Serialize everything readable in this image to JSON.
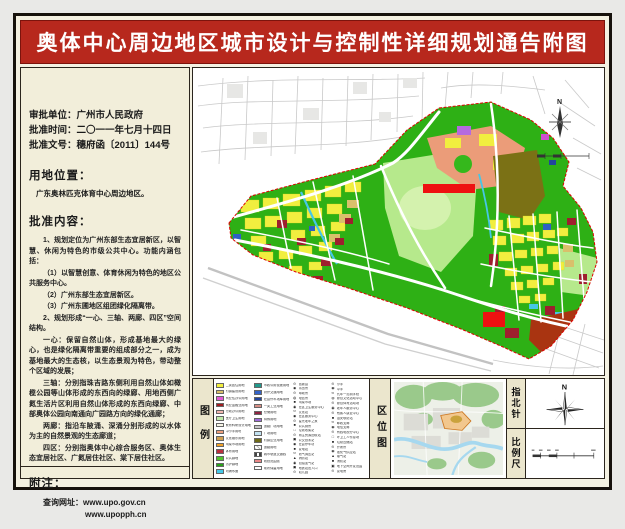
{
  "title": "奥体中心周边地区城市设计与控制性详细规划通告附图",
  "info": {
    "approval_unit_label": "审批单位：",
    "approval_unit": "广州市人民政府",
    "approval_date_label": "批准时间：",
    "approval_date": "二〇一一年七月十四日",
    "approval_doc_label": "批准文号：",
    "approval_doc": "穗府函〔2011〕144号"
  },
  "location_section": {
    "heading": "用地位置：",
    "body": "广东奥林匹克体育中心周边地区。"
  },
  "content_section": {
    "heading": "批准内容：",
    "paragraphs": [
      {
        "t": "1、规划定位为广州东部生态宜居新区，以智慧、休闲为特色的市级公共中心。功能内涵包括："
      },
      {
        "t": "（1）以智慧创意、体育休闲为特色的地区公共服务中心。"
      },
      {
        "t": "（2）广州东部生态宜居新区。"
      },
      {
        "t": "（3）广州东圃地区组团绿化隔离带。"
      },
      {
        "t": "2、规划形成“一心、三轴、两廊、四区”空间结构。"
      },
      {
        "t": "一心：保留自然山体，形成基地最大的绿心，也是绿化隔离带重要的组成部分之一，成为基地最大的生态核，以生态景观为特色，带动整个区域的发展；"
      },
      {
        "t": "三轴：分别指珠吉路东侧利用自然山体如橄榄公园等山体形成的东西向的绿廊、用地西侧广氮生活片区利用自然山体形成的东西向绿廊、中部奥体公园向南通向广园路方向的绿化通廊；"
      },
      {
        "t": "两廊：指沿车陂涌、深涌分别形成的以水体为主的自然景观的生态廊道；"
      },
      {
        "t": "四区：分别指奥体中心综合服务区、奥体生态宜居社区、广氮居住社区、棠下居住社区。"
      }
    ]
  },
  "notes_section": {
    "heading": "附注：",
    "query_label": "查询网址：",
    "url1": "www.upo.gov.cn",
    "url2": "www.upopph.cn"
  },
  "legend": {
    "label": "图例",
    "col1": [
      {
        "c": "#f2ee3e",
        "label": "二类居住用地"
      },
      {
        "c": "#d9c06b",
        "label": "村镇建设用地"
      },
      {
        "c": "#e05ad5",
        "label": "商业性办公用地"
      },
      {
        "c": "#a11d20",
        "label": "商业金融业用地"
      },
      {
        "c": "#f2b6b0",
        "label": "行政办公用地"
      },
      {
        "c": "#bfe9a9",
        "label": "医疗卫生用地"
      },
      {
        "c": "#f7f5e6",
        "label": "教育科研设计用地"
      },
      {
        "c": "#efa07d",
        "label": "中小学用地"
      },
      {
        "c": "#cfa052",
        "label": "文化娱乐用地"
      },
      {
        "c": "#f0a229",
        "label": "肉菜市场用地"
      },
      {
        "c": "#bb2e3e",
        "label": "体育用地"
      },
      {
        "c": "#53c32e",
        "label": "公共绿地"
      },
      {
        "c": "#2aa31a",
        "label": "防护绿地"
      },
      {
        "c": "#45c8e8",
        "label": "河涌水面"
      }
    ],
    "col2": [
      {
        "c": "#22998c",
        "label": "市政公用设施用地"
      },
      {
        "c": "#3463c8",
        "label": "对外交通用地"
      },
      {
        "c": "#22459e",
        "label": "社会停车场库用地"
      },
      {
        "c": "#d98f86",
        "label": "一类工业用地"
      },
      {
        "c": "#8e2340",
        "label": "仓储用地"
      },
      {
        "c": "#9e6bd9",
        "label": "特殊用地"
      },
      {
        "c": "#c6c6c6",
        "label": "道路广场用地"
      },
      {
        "c": "#c2e2f2",
        "label": "广场用地"
      },
      {
        "c": "#6f6b18",
        "label": "村镇企业用地"
      },
      {
        "c": "repeating-linear-gradient(45deg,#bbbbbb 0 1px,#ffffff 1px 3px)",
        "label": "道路用地"
      },
      {
        "c": "repeating-linear-gradient(90deg,#444444 0 2px,#ffffff 2px 4px)",
        "label": "城市轨道交通线"
      },
      {
        "c": "linear-gradient(#ffffff 35%,#d41111 35%,#d41111 65%,#ffffff 65%)",
        "label": "规划范围线"
      },
      {
        "c": "#ffffff",
        "label": "现状保留用地"
      }
    ],
    "col3": [
      {
        "sym": "⊙",
        "label": "居委会"
      },
      {
        "sym": "◉",
        "label": "派出所"
      },
      {
        "sym": "⊙",
        "label": "邮政所"
      },
      {
        "sym": "◍",
        "label": "电信所"
      },
      {
        "sym": "■",
        "label": "肉菜市场"
      },
      {
        "sym": "◉",
        "label": "社区卫生服务中心"
      },
      {
        "sym": "⊙",
        "label": "文化站"
      },
      {
        "sym": "◉",
        "label": "社区服务中心"
      },
      {
        "sym": "⊙",
        "label": "星光老年之家"
      },
      {
        "sym": "■",
        "label": "公共厕所"
      },
      {
        "sym": "□",
        "label": "垃圾收集站"
      },
      {
        "sym": "⊙",
        "label": "再生资源回收站"
      },
      {
        "sym": "▣",
        "label": "公交首末站"
      },
      {
        "sym": "◉",
        "label": "社会停车场"
      },
      {
        "sym": "■",
        "label": "变电站"
      },
      {
        "sym": "⊙",
        "label": "燃气调压站"
      },
      {
        "sym": "▲",
        "label": "消防站"
      },
      {
        "sym": "◉",
        "label": "加油加气站"
      },
      {
        "sym": "▣",
        "label": "地铁站出入口"
      },
      {
        "sym": "⊙",
        "label": "幼儿园"
      }
    ],
    "col4": [
      {
        "sym": "⊙",
        "label": "小学"
      },
      {
        "sym": "◉",
        "label": "中学"
      },
      {
        "sym": "⊙",
        "label": "九年一贯制学校"
      },
      {
        "sym": "◍",
        "label": "综合文化活动中心"
      },
      {
        "sym": "⊙",
        "label": "综合体育活动场"
      },
      {
        "sym": "◉",
        "label": "老年人服务中心"
      },
      {
        "sym": "⊙",
        "label": "残疾人康复中心"
      },
      {
        "sym": "■",
        "label": "治安联防站"
      },
      {
        "sym": "⊙",
        "label": "邮政支局"
      },
      {
        "sym": "◉",
        "label": "电信支局"
      },
      {
        "sym": "⊙",
        "label": "有线电视分中心"
      },
      {
        "sym": "□",
        "label": "环卫工人作息场"
      },
      {
        "sym": "■",
        "label": "垃圾压缩站"
      },
      {
        "sym": "⊙",
        "label": "开闭所"
      },
      {
        "sym": "◉",
        "label": "液化气供应站"
      },
      {
        "sym": "▲",
        "label": "煤气站"
      },
      {
        "sym": "■",
        "label": "消防站"
      },
      {
        "sym": "▣",
        "label": "地下空间开发范围"
      },
      {
        "sym": "⊙",
        "label": "变电房"
      }
    ]
  },
  "location_map": {
    "label": "区位图"
  },
  "north": {
    "label": "指北针",
    "n": "N"
  },
  "scale": {
    "label": "比例尺"
  },
  "map": {
    "north_label": "N"
  }
}
